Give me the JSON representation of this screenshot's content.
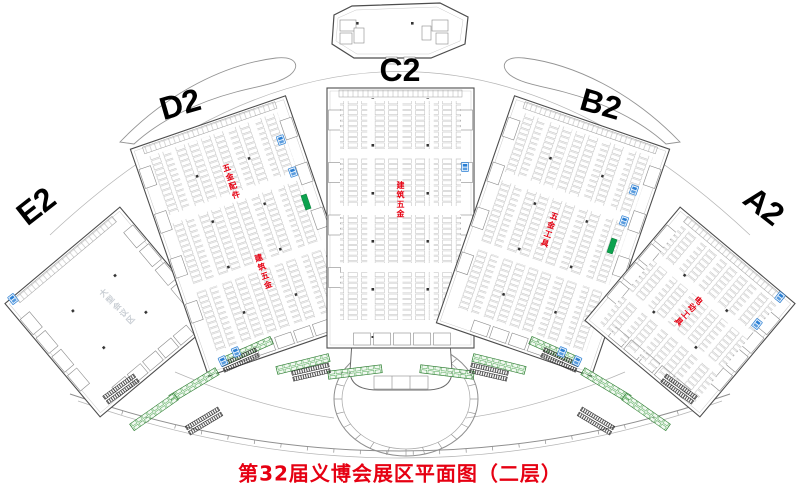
{
  "map": {
    "caption": "第32届义博会展区平面图（二层）",
    "halls": [
      {
        "id": "E2",
        "label": "E2",
        "categories": [
          "大型会议区"
        ]
      },
      {
        "id": "D2",
        "label": "D2",
        "categories": [
          "五金配件",
          "建筑五金"
        ]
      },
      {
        "id": "C2",
        "label": "C2",
        "categories": [
          "建筑五金"
        ]
      },
      {
        "id": "B2",
        "label": "B2",
        "categories": [
          "五金工具"
        ]
      },
      {
        "id": "A2",
        "label": "A2",
        "categories": [
          "电动工具"
        ]
      }
    ],
    "colors": {
      "category_label": "#e60012",
      "inactive_area_label": "#c9ced4",
      "caption": "#e60012",
      "toilet": "#2a7fd4",
      "exit_marker": "#0ca24e",
      "service_booth": "#43a047",
      "booth_outline": "#b3b3b3"
    }
  }
}
